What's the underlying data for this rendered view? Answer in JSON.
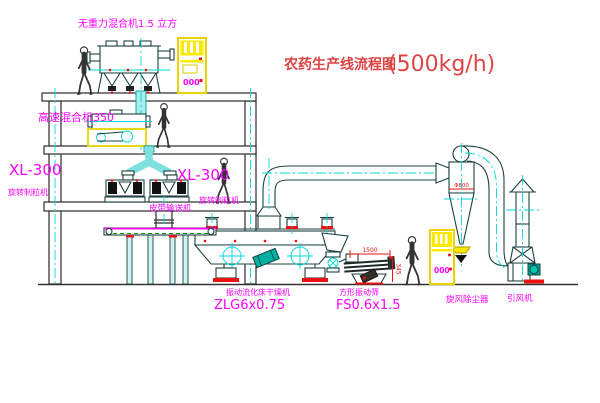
{
  "title": {
    "name": "农药生产线流程图",
    "capacity": "(500kg/h)"
  },
  "equipment_labels": {
    "gravity_mixer": "无重力混合机1.5 立方",
    "high_speed_mixer": "高速混合机350",
    "granulator_left_model": "XL-300",
    "granulator_left_name": "旋转制粒机",
    "granulator_center_model": "XL-300",
    "granulator_center_name": "旋转制粒机",
    "belt_conveyor": "皮带输送机",
    "fluid_bed_dryer_name": "振动流化床干燥机",
    "fluid_bed_dryer_model": "ZLG6x0.75",
    "vibrating_screen_name": "方形振动筛",
    "vibrating_screen_model": "FS0.6x1.5",
    "cyclone_dust_collector": "旋风除尘器",
    "induced_draft_fan": "引风机"
  },
  "dimensions": {
    "cyclone_diameter": "Φ800",
    "screen_length": "1500",
    "screen_height": "345"
  },
  "control_cabinets": {
    "cabinet1_display": "000",
    "cabinet2_display": "000"
  },
  "colors": {
    "outline": "#1e4040",
    "centerline_cyan": "#00d9d9",
    "label_magenta": "#ff00ff",
    "accent_red": "#ee1111",
    "cabinet_yellow": "#ffe800",
    "title_red": "#dd4444"
  }
}
